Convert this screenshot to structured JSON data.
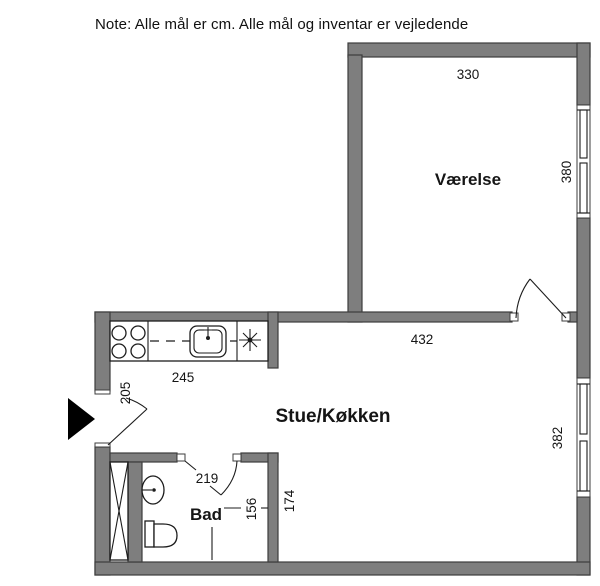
{
  "note": "Note: Alle mål er cm. Alle mål og inventar er vejledende",
  "colors": {
    "wall_fill": "#7e7e7e",
    "wall_outline": "#3d3d3d",
    "line": "#1c1c1c",
    "background": "#ffffff"
  },
  "rooms": {
    "vaerelse": {
      "label": "Værelse"
    },
    "stue_koekken": {
      "label": "Stue/Køkken"
    },
    "bad": {
      "label": "Bad"
    }
  },
  "dimensions": {
    "vaerelse_width": "330",
    "vaerelse_depth": "380",
    "stue_width": "432",
    "stue_depth": "382",
    "kitchen_counter": "245",
    "entrance_door": "205",
    "bad_width": "219",
    "bad_inner": "156",
    "bad_outer": "174"
  },
  "symbols": {
    "entrance_arrow": "entrance-arrow",
    "stove": "4-burner stove",
    "kitchen_sink": "kitchen sink",
    "extractor_star": "extractor star",
    "duct_shaft": "duct shaft",
    "washbasin": "washbasin",
    "toilet": "toilet"
  }
}
